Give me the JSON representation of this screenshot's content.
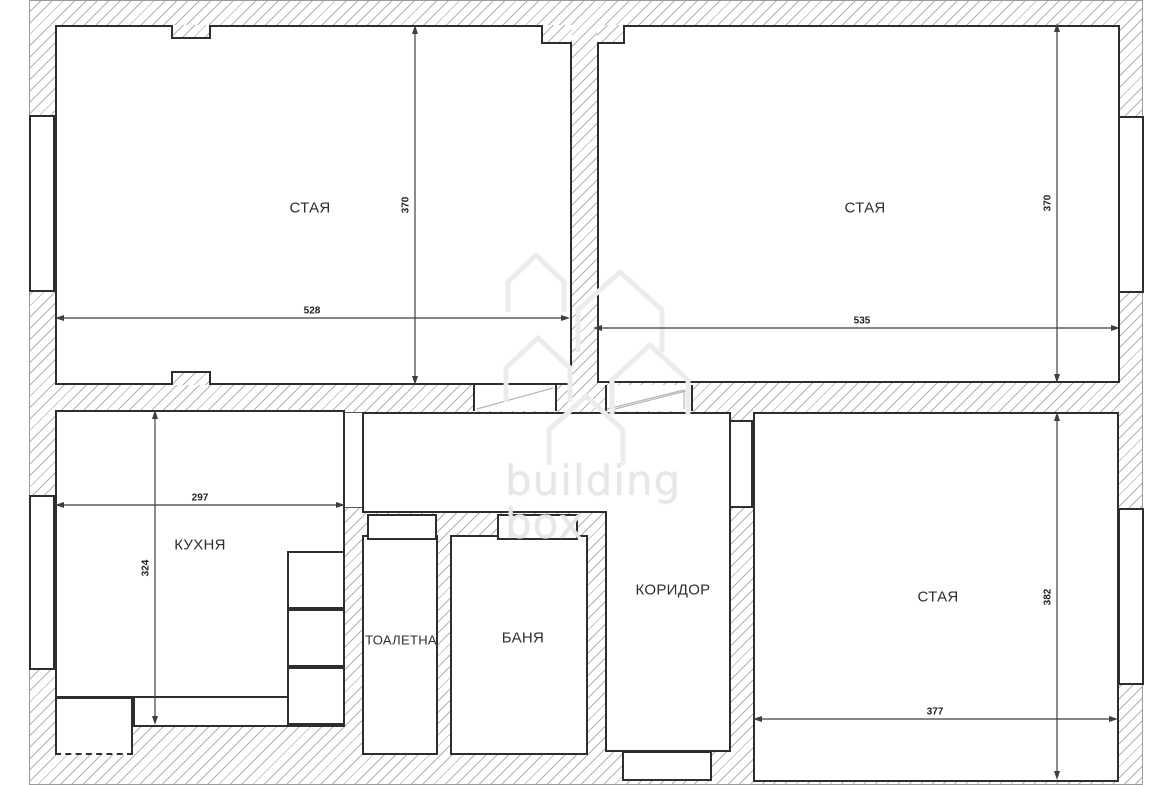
{
  "watermark": {
    "line1": "building",
    "line2": "box"
  },
  "rooms": {
    "room_top_left": {
      "label": "СТАЯ",
      "width_dim": "528",
      "height_dim": "370"
    },
    "room_top_right": {
      "label": "СТАЯ",
      "width_dim": "535",
      "height_dim": "370"
    },
    "kitchen": {
      "label": "КУХНЯ",
      "width_dim": "297",
      "height_dim": "324"
    },
    "toilet": {
      "label": "ТОАЛЕТНА"
    },
    "bath": {
      "label": "БАНЯ"
    },
    "corridor": {
      "label": "КОРИДОР"
    },
    "room_bottom_right": {
      "label": "СТАЯ",
      "width_dim": "377",
      "height_dim": "382"
    }
  },
  "colors": {
    "wall_line": "#2e2e2e",
    "wall_hatch": "#b3b3b3",
    "dimension_line": "#3f3f3f",
    "watermark": "#e7e7e7"
  }
}
